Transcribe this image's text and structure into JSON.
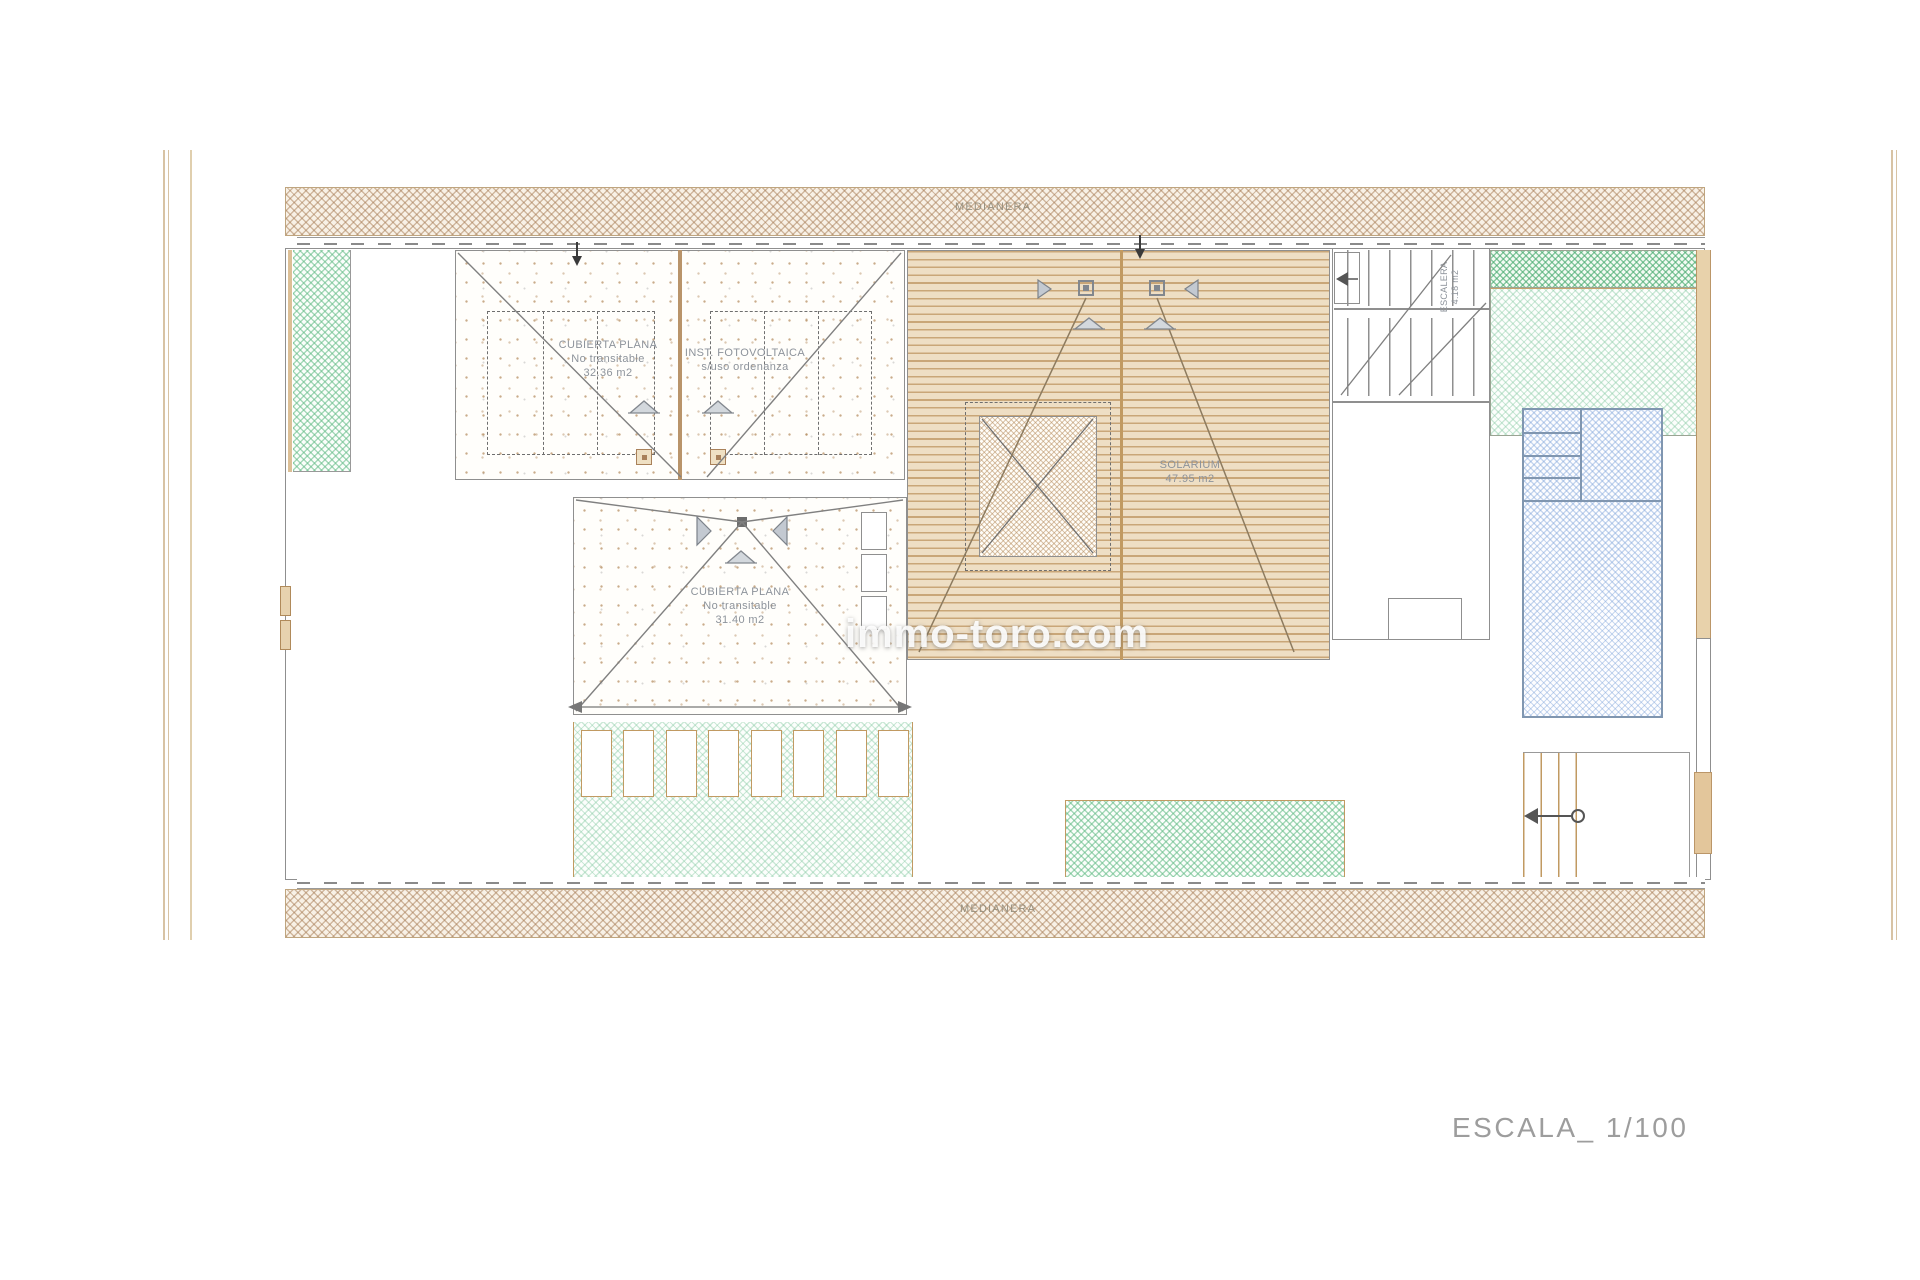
{
  "plan": {
    "party_wall_top": "MEDIANERA",
    "party_wall_bottom": "MEDIANERA",
    "scale_label": "ESCALA_ 1/100",
    "watermark": "immo-toro.com",
    "areas": {
      "flat_roof_pv": {
        "line1": "CUBIERTA PLANA",
        "line2": "No transitable",
        "line3": "32.36 m2"
      },
      "pv_install": {
        "line1": "INST. FOTOVOLTAICA",
        "line2": "s/uso ordenanza"
      },
      "flat_roof_hip": {
        "line1": "CUBIERTA PLANA",
        "line2": "No transitable",
        "line3": "31.40 m2"
      },
      "solarium": {
        "line1": "SOLARIUM",
        "line2": "47.95 m2"
      },
      "stair": {
        "line1": "ESCALERA",
        "line2": "4.18 m2"
      }
    },
    "colors": {
      "wall_line": "#8f8f8f",
      "tan_accent": "#c19a62",
      "party_hatch": "#a97c50",
      "green_hatch": "#5fba84",
      "pool_hatch": "#7da3d9",
      "deck_line": "#c9a678",
      "label_text": "#8d939b",
      "scale_text": "#9d9d9d"
    }
  }
}
